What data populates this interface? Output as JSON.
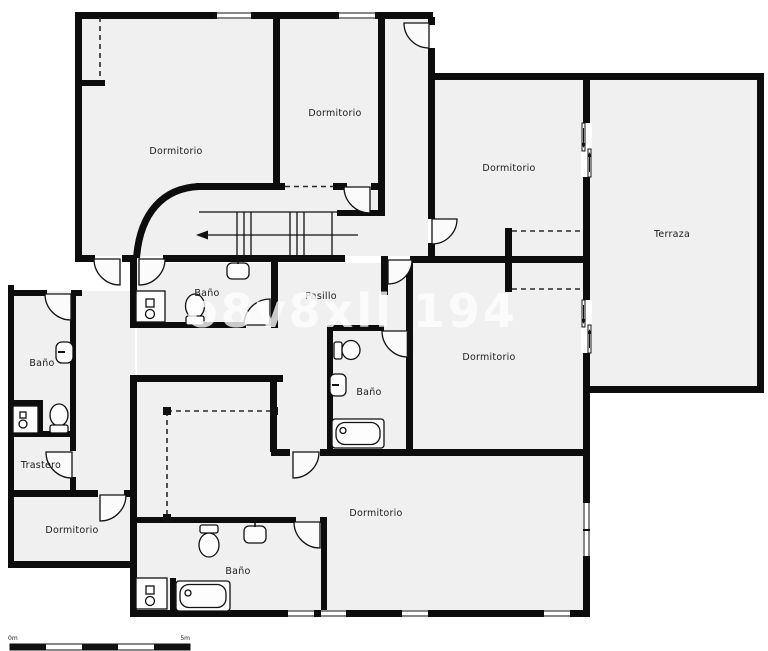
{
  "floorplan": {
    "watermark": "o8v8xll 194",
    "scale_bar": {
      "start_label": "0m",
      "end_label": "5m"
    },
    "rooms": [
      {
        "name": "dormitorio-top-left",
        "label": "Dormitorio"
      },
      {
        "name": "dormitorio-top-middle",
        "label": "Dormitorio"
      },
      {
        "name": "dormitorio-top-right",
        "label": "Dormitorio"
      },
      {
        "name": "terraza",
        "label": "Terraza"
      },
      {
        "name": "pasillo",
        "label": "Pasillo"
      },
      {
        "name": "bano-junto-escalera",
        "label": "Baño"
      },
      {
        "name": "bano-izquierda",
        "label": "Baño"
      },
      {
        "name": "trastero",
        "label": "Trastero"
      },
      {
        "name": "dormitorio-abajo-izq",
        "label": "Dormitorio"
      },
      {
        "name": "bano-centro",
        "label": "Baño"
      },
      {
        "name": "dormitorio-derecha",
        "label": "Dormitorio"
      },
      {
        "name": "dormitorio-abajo",
        "label": "Dormitorio"
      },
      {
        "name": "bano-abajo",
        "label": "Baño"
      }
    ],
    "fixtures": [
      "toilet",
      "sink",
      "bathtub",
      "washbasin-cabinet",
      "cistern",
      "staircase",
      "sliding-door",
      "window",
      "door"
    ]
  }
}
